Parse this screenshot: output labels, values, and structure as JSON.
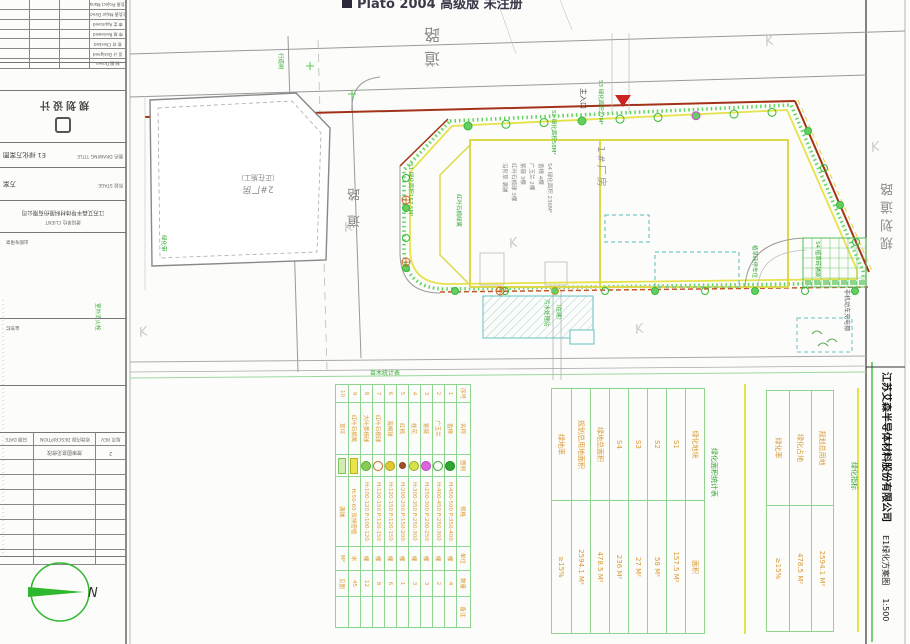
{
  "watermark": {
    "icon": "app-window-icon",
    "text": "Plato 2004 高级版 未注册"
  },
  "frame_title": {
    "company": "江苏艾森半导体材料股份有限公司",
    "drawing": "E1绿化方案图",
    "scale": "1:500"
  },
  "roads": {
    "top_label": "道路",
    "left_label": "道路",
    "right_label": "规划道路"
  },
  "compass": {
    "north_label": "N"
  },
  "title_block": {
    "logo_text": "规划设计",
    "signature_rows": [
      {
        "label": "项目负责 Project Manager"
      },
      {
        "label": "专业负责 Major Director"
      },
      {
        "label": "审 定 Approved"
      },
      {
        "label": "审 核 Reviewed"
      },
      {
        "label": "校 对 Checked"
      },
      {
        "label": "设 计 Designed"
      },
      {
        "label": "制 图 Drawn"
      }
    ],
    "info_rows": [
      {
        "label": "图名 DRAWING TITLE",
        "value": "E1 绿化方案图"
      },
      {
        "label": "阶段 STAGE",
        "value": "方案"
      },
      {
        "label": "建设单位 CLIENT",
        "value": "江苏艾森半导体材料股份有限公司"
      }
    ],
    "stamp_note": "出图专用章",
    "sign_note": "会签栏",
    "revision": {
      "headers": [
        "日期 DATE",
        "修改内容 DESCRIPTION",
        "版次 REV"
      ],
      "entries": [
        [
          "",
          "按审图意见修改",
          "2"
        ]
      ]
    }
  },
  "site": {
    "main_entrance_label": "主入口",
    "building1_label": "1#厂房",
    "building2_label": "2#厂房",
    "building2_status": "（正在施工）",
    "building1_notes": [
      "S4 绿化面积 236M²",
      "香樟 4棵",
      "广玉兰 2棵",
      "紫薇 3棵",
      "红叶石楠球 3棵",
      "沿阶草 满铺"
    ],
    "green_notes": [
      "S1 绿化面积157.5M²",
      "红叶石楠绿篱",
      "S2 绿化面积58M²",
      "S3 绿化面积27M²",
      "植草砖停车位",
      "S4 植草砖铺装",
      "污水处理站",
      "（在建）",
      "行道树",
      "绿化带",
      "室外消火栓"
    ],
    "charging_shed_label": "非机动车充电棚"
  },
  "legend_table": {
    "title": "苗木统计表",
    "headers": [
      "序号",
      "名称",
      "图例",
      "规格",
      "单位",
      "数量",
      "备注"
    ],
    "rows": [
      {
        "no": "1",
        "name": "香樟",
        "symbol": {
          "shape": "circle",
          "fill": "#2ea82e",
          "stroke": "#1b7e1b"
        },
        "spec": "H:450-500 P:350-400",
        "unit": "棵",
        "qty": "4",
        "remark": ""
      },
      {
        "no": "2",
        "name": "广玉兰",
        "symbol": {
          "shape": "circle",
          "fill": "none",
          "stroke": "#2ea82e"
        },
        "spec": "H:400-450 P:250-300",
        "unit": "棵",
        "qty": "2",
        "remark": ""
      },
      {
        "no": "3",
        "name": "紫薇",
        "symbol": {
          "shape": "circle",
          "fill": "#dd66dd",
          "stroke": "#bb44bb"
        },
        "spec": "H:250-300 P:200-250",
        "unit": "棵",
        "qty": "3",
        "remark": ""
      },
      {
        "no": "4",
        "name": "桂花",
        "symbol": {
          "shape": "circle",
          "fill": "#d8e050",
          "stroke": "#99aa22"
        },
        "spec": "H:300-350 P:250-300",
        "unit": "棵",
        "qty": "3",
        "remark": ""
      },
      {
        "no": "5",
        "name": "红枫",
        "symbol": {
          "shape": "dot",
          "fill": "#a05030",
          "stroke": "#884422"
        },
        "spec": "H:200-250 P:150-200",
        "unit": "棵",
        "qty": "1",
        "remark": ""
      },
      {
        "no": "6",
        "name": "海桐球",
        "symbol": {
          "shape": "circle",
          "fill": "#e0c830",
          "stroke": "#b8a020"
        },
        "spec": "H:120-150 P:120-150",
        "unit": "棵",
        "qty": "6",
        "remark": ""
      },
      {
        "no": "7",
        "name": "红叶石楠球",
        "symbol": {
          "shape": "target",
          "fill": "none",
          "stroke": "#cc6622"
        },
        "spec": "H:120-150 P:120-150",
        "unit": "棵",
        "qty": "8",
        "remark": ""
      },
      {
        "no": "8",
        "name": "大叶黄杨球",
        "symbol": {
          "shape": "circle",
          "fill": "#88cc55",
          "stroke": "#55aa33"
        },
        "spec": "H:100-120 P:100-120",
        "unit": "棵",
        "qty": "12",
        "remark": ""
      },
      {
        "no": "9",
        "name": "红叶石楠篱",
        "symbol": {
          "shape": "rect",
          "fill": "#e8e44a",
          "stroke": "#b8b020"
        },
        "spec": "H:50-60 双排密植",
        "unit": "米",
        "qty": "45",
        "remark": ""
      },
      {
        "no": "10",
        "name": "草坪",
        "symbol": {
          "shape": "hatch",
          "fill": "#d2ecb4",
          "stroke": "#7fbf5f"
        },
        "spec": "满铺",
        "unit": "M²",
        "qty": "见图",
        "remark": ""
      }
    ]
  },
  "area_table": {
    "title": "绿化面积统计表",
    "rows": [
      [
        "绿化地块",
        "面积"
      ],
      [
        "S1",
        "157.5 M²"
      ],
      [
        "S2",
        "58 M²"
      ],
      [
        "S3",
        "27 M²"
      ],
      [
        "S4",
        "236 M²"
      ],
      [
        "绿地总面积",
        "478.5 M²"
      ],
      [
        "规划总用地面积",
        "2594.1 M²"
      ],
      [
        "绿地率",
        "≥15%"
      ]
    ]
  },
  "index_table": {
    "title": "绿化指标",
    "rows": [
      [
        "规划总用地",
        "2594.1 M²"
      ],
      [
        "绿化占地",
        "478.5 M²"
      ],
      [
        "绿化率",
        "≥15%"
      ]
    ]
  },
  "colors": {
    "boundary_red": "#a23318",
    "landscape_green": "#44cc44",
    "highlight_yellow": "#e6e24a",
    "table_line_green": "#8fd58f",
    "table_text_orange": "#d89a34",
    "annotation_green": "#33aa33",
    "road_gray": "#999999",
    "entrance_red": "#cc2222",
    "water_cyan": "#66c2c2",
    "compass_green": "#2db82d"
  }
}
